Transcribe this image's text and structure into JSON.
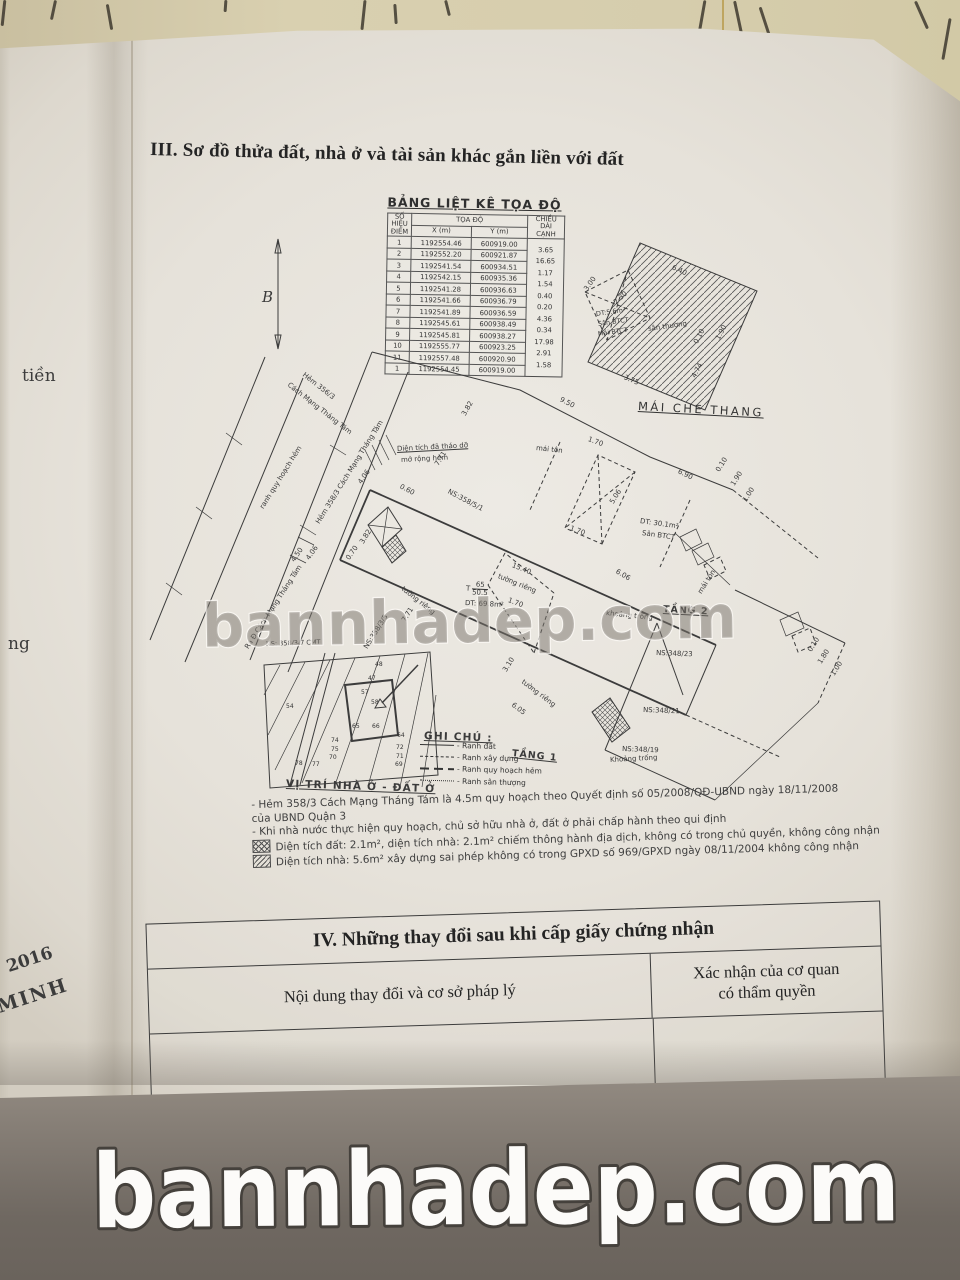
{
  "page": {
    "title3": "III. Sơ đồ thửa đất, nhà ở và tài sản khác gắn liền với đất",
    "side": {
      "tien": "tiền",
      "ng": "ng",
      "y2016": "2016",
      "minh": "MINH"
    }
  },
  "watermark": {
    "text": "bannhadep.com"
  },
  "coord_table": {
    "title": "BẢNG LIỆT KÊ TỌA ĐỘ",
    "headers": {
      "h_point_1": "SỐ HIỆU",
      "h_point_2": "ĐIỂM",
      "h_toado": "TỌA ĐỘ",
      "h_x": "X (m)",
      "h_y": "Y (m)",
      "h_len_1": "CHIỀU DÀI",
      "h_len_2": "CẠNH"
    },
    "rows": [
      {
        "p": "1",
        "x": "1192554.46",
        "y": "600919.00",
        "len": "3.65"
      },
      {
        "p": "2",
        "x": "1192552.20",
        "y": "600921.87",
        "len": "16.65"
      },
      {
        "p": "3",
        "x": "1192541.54",
        "y": "600934.51",
        "len": "1.17"
      },
      {
        "p": "4",
        "x": "1192542.15",
        "y": "600935.36",
        "len": "1.54"
      },
      {
        "p": "5",
        "x": "1192541.28",
        "y": "600936.63",
        "len": "0.40"
      },
      {
        "p": "6",
        "x": "1192541.66",
        "y": "600936.79",
        "len": "0.20"
      },
      {
        "p": "7",
        "x": "1192541.89",
        "y": "600936.59",
        "len": "4.36"
      },
      {
        "p": "8",
        "x": "1192545.61",
        "y": "600938.49",
        "len": "0.34"
      },
      {
        "p": "9",
        "x": "1192545.81",
        "y": "600938.27",
        "len": "17.98"
      },
      {
        "p": "10",
        "x": "1192555.77",
        "y": "600923.25",
        "len": "2.91"
      },
      {
        "p": "11",
        "x": "1192557.48",
        "y": "600920.90",
        "len": "1.58"
      },
      {
        "p": "1",
        "x": "1192554.45",
        "y": "600919.00",
        "len": ""
      }
    ]
  },
  "map": {
    "labels": {
      "north_b": "B",
      "hem_356_line1": "Hẻm 356/3",
      "hem_356_line2": "Cách Mạng Tháng Tám",
      "ranh_quy_hoach_hem": "ranh quy hoạch hẻm",
      "hem_358_street": "Hẻm 358/3 Cách Mạng Tháng Tám",
      "ra_duong_cmt8": "Ra Đ.Cách Mạng Tháng Tám",
      "thao_do_line1": "Diện tích đã tháo dỡ",
      "thao_do_line2": "mở rộng hẻm",
      "ns_358_5_1": "NS:358/5/1",
      "ns_358_3_5": "NS:358/3/5",
      "ns_358_3_7": "NS: 358/3/7 CMT",
      "ns_348_23": "NS:348/23",
      "ns_348_21": "NS:348/21",
      "ns_348_19": "NS:348/19",
      "mai_ton": "mái tôn",
      "dt_30_1": "DT: 30.1m²",
      "san_btct": "Sân BTCT",
      "mai_btct": "Mái BTCT",
      "dt_5_6": "DT:5.6m²",
      "dt_69_8": "DT: 69.8m²",
      "t_label": "T",
      "t_num": "65",
      "t_den": "50.5",
      "tuong_rieng": "tường riêng",
      "khoang_trong": "khoảng trống",
      "khoang_trong_cap": "Khoảng trống",
      "san_thuong": "sân thượng",
      "tang_1": "TẦNG 1",
      "tang_2": "TẦNG 2",
      "mai_che_thang": "MÁI CHE THANG",
      "vi_tri": "VỊ TRÍ NHÀ Ở - ĐẤT Ở",
      "ghi_chu": "GHI CHÚ :",
      "d_3_00": "3.00",
      "d_2_30": "2.30",
      "d_6_40": "6.40",
      "d_1_90": "1.90",
      "d_0_10": "0.10",
      "d_3_75": "3.75",
      "d_4_74": "4.74",
      "d_9_50": "9.50",
      "d_6_90": "6.90",
      "d_7_71": "7.71",
      "d_3_82": "3.82",
      "d_4_06": "4.06",
      "d_4_50": "4.50",
      "d_0_60": "0.60",
      "d_0_70": "0.70",
      "d_15_40": "15.40",
      "d_1_70": "1.70",
      "d_5_06": "5.06",
      "d_3_10": "3.10",
      "d_6_05": "6.05",
      "d_6_06": "6.06",
      "d_1_00": "1.00",
      "d_1_80": "1.80"
    },
    "vitri_numbers": [
      "48",
      "47",
      "57",
      "58",
      "54",
      "65",
      "66",
      "64",
      "74",
      "75",
      "70",
      "78",
      "77",
      "72",
      "71",
      "69"
    ]
  },
  "legend": {
    "items": [
      {
        "label": "- Ranh đất"
      },
      {
        "label": "- Ranh xây dựng"
      },
      {
        "label": "- Ranh quy hoạch hẻm"
      },
      {
        "label": "- Ranh sân thượng"
      }
    ]
  },
  "notes": {
    "line1": "- Hẻm 358/3 Cách Mạng Tháng Tám là 4.5m quy hoạch theo Quyết định số 05/2008/QĐ-UBND ngày 18/11/2008",
    "line1b": "của UBND Quận 3",
    "line2": "- Khi nhà nước thực hiện quy hoạch, chủ sở hữu nhà ở, đất ở phải chấp hành theo qui định",
    "line3": "Diện tích đất: 2.1m², diện tích nhà: 2.1m² chiếm thông hành địa dịch, không có trong chủ quyền, không công nhận",
    "line4": "Diện tích nhà: 5.6m² xây dựng sai phép không có trong GPXD số 969/GPXD ngày 08/11/2004 không công nhận"
  },
  "section4": {
    "title": "IV. Những thay đổi sau khi cấp giấy chứng nhận",
    "col1": "Nội dung thay đổi và cơ sở pháp lý",
    "col2a": "Xác nhận của cơ quan",
    "col2b": "có thẩm quyền"
  }
}
